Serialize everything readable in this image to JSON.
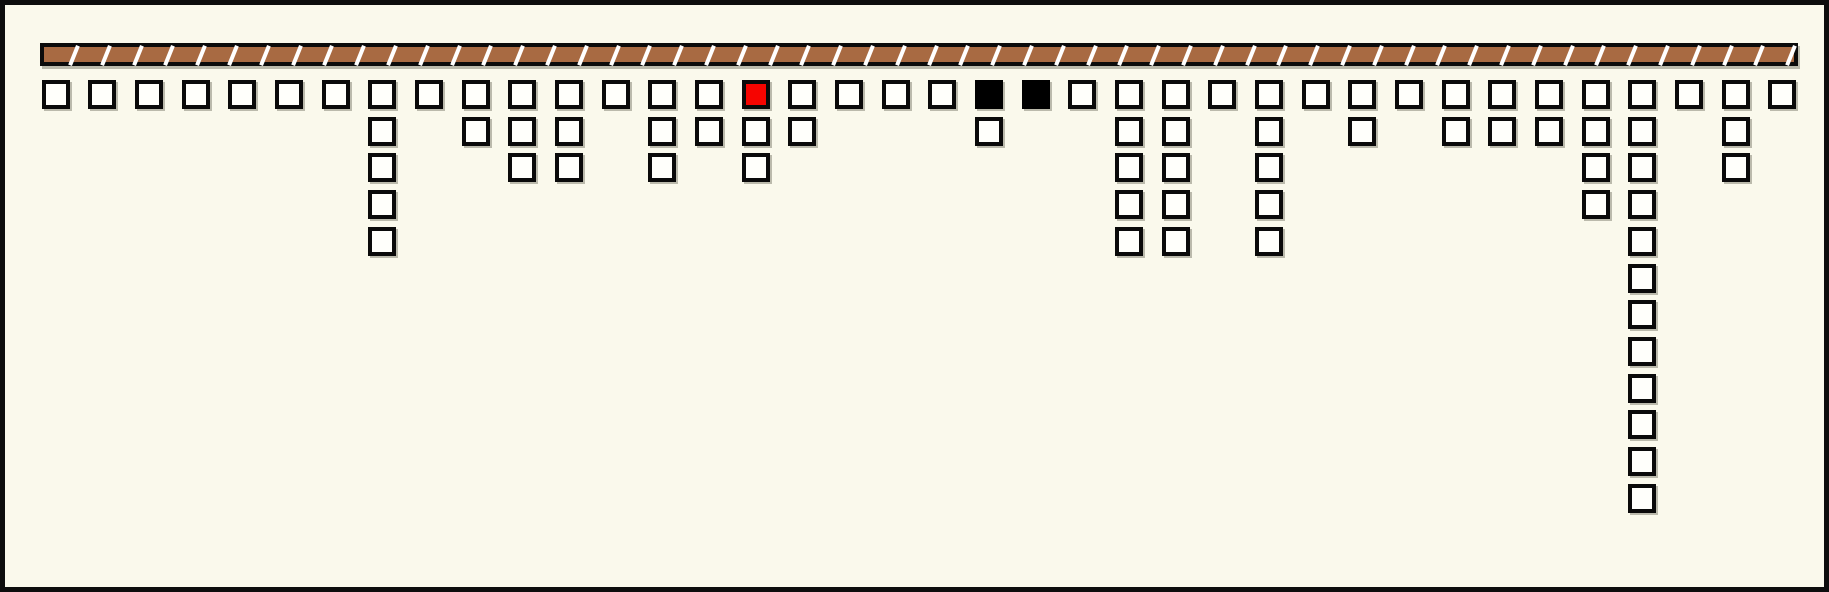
{
  "scene": {
    "width": 1829,
    "height": 592,
    "colors": {
      "background": "#faf9ec",
      "frame_border": "#0d0d0d",
      "bar_fill": "#a86a42",
      "bar_border": "#0b0b0b",
      "slash": "#ffffff",
      "cell_fill": "#fffffb",
      "cell_border": "#0a0a0a",
      "red_cell": "#f60400",
      "black_cell": "#000000"
    }
  },
  "bar": {
    "x": 35,
    "y": 38,
    "width": 1758,
    "height": 23,
    "segment_count": 55,
    "segment_pitch": 31.8,
    "slash_start": 28
  },
  "grid": {
    "first_col_center": 50.7,
    "col_pitch": 46.67,
    "first_row_top": 75,
    "row_pitch": 36.7,
    "cell_size": 28
  },
  "stats": {
    "column_count": 38,
    "max_depth": 12,
    "total_cells": 81,
    "red_cell_column": 16,
    "black_cell_columns": [
      21,
      22
    ]
  },
  "columns": [
    {
      "index": 1,
      "depth": 1,
      "color": "white"
    },
    {
      "index": 2,
      "depth": 1,
      "color": "white"
    },
    {
      "index": 3,
      "depth": 1,
      "color": "white"
    },
    {
      "index": 4,
      "depth": 1,
      "color": "white"
    },
    {
      "index": 5,
      "depth": 1,
      "color": "white"
    },
    {
      "index": 6,
      "depth": 1,
      "color": "white"
    },
    {
      "index": 7,
      "depth": 1,
      "color": "white"
    },
    {
      "index": 8,
      "depth": 5,
      "color": "white"
    },
    {
      "index": 9,
      "depth": 1,
      "color": "white"
    },
    {
      "index": 10,
      "depth": 2,
      "color": "white"
    },
    {
      "index": 11,
      "depth": 3,
      "color": "white"
    },
    {
      "index": 12,
      "depth": 3,
      "color": "white"
    },
    {
      "index": 13,
      "depth": 1,
      "color": "white"
    },
    {
      "index": 14,
      "depth": 3,
      "color": "white"
    },
    {
      "index": 15,
      "depth": 2,
      "color": "white"
    },
    {
      "index": 16,
      "depth": 3,
      "color": "red"
    },
    {
      "index": 17,
      "depth": 2,
      "color": "white"
    },
    {
      "index": 18,
      "depth": 1,
      "color": "white"
    },
    {
      "index": 19,
      "depth": 1,
      "color": "white"
    },
    {
      "index": 20,
      "depth": 1,
      "color": "white"
    },
    {
      "index": 21,
      "depth": 2,
      "color": "black"
    },
    {
      "index": 22,
      "depth": 1,
      "color": "black"
    },
    {
      "index": 23,
      "depth": 1,
      "color": "white"
    },
    {
      "index": 24,
      "depth": 5,
      "color": "white"
    },
    {
      "index": 25,
      "depth": 5,
      "color": "white"
    },
    {
      "index": 26,
      "depth": 1,
      "color": "white"
    },
    {
      "index": 27,
      "depth": 5,
      "color": "white"
    },
    {
      "index": 28,
      "depth": 1,
      "color": "white"
    },
    {
      "index": 29,
      "depth": 2,
      "color": "white"
    },
    {
      "index": 30,
      "depth": 1,
      "color": "white"
    },
    {
      "index": 31,
      "depth": 2,
      "color": "white"
    },
    {
      "index": 32,
      "depth": 2,
      "color": "white"
    },
    {
      "index": 33,
      "depth": 2,
      "color": "white"
    },
    {
      "index": 34,
      "depth": 4,
      "color": "white"
    },
    {
      "index": 35,
      "depth": 12,
      "color": "white"
    },
    {
      "index": 36,
      "depth": 1,
      "color": "white"
    },
    {
      "index": 37,
      "depth": 3,
      "color": "white"
    },
    {
      "index": 38,
      "depth": 1,
      "color": "white"
    }
  ]
}
